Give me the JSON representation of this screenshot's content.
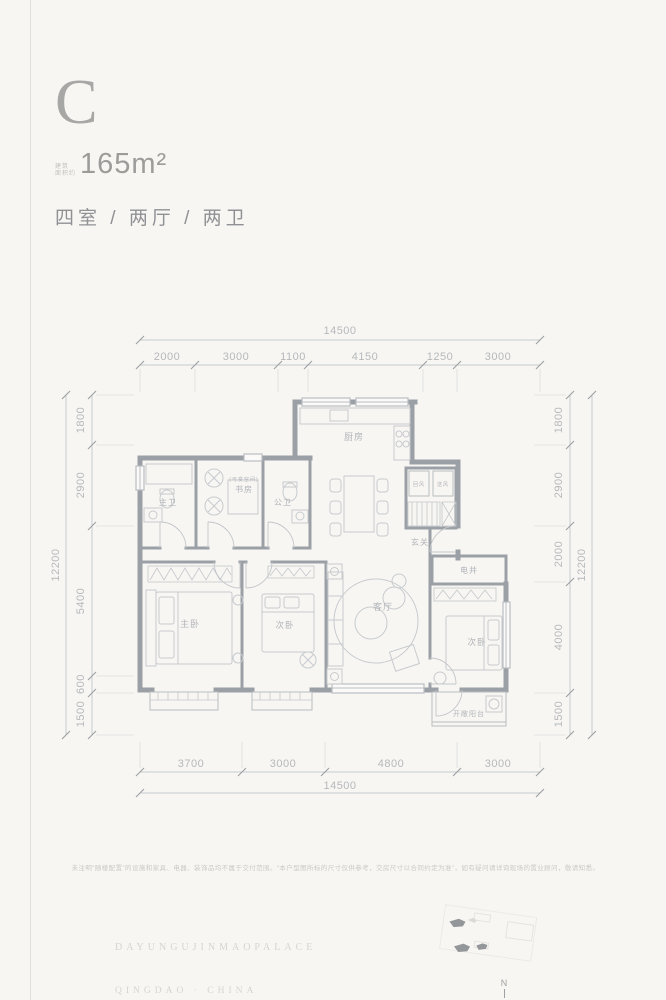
{
  "header": {
    "unit_letter": "C",
    "area_label_line1": "建筑",
    "area_label_line2": "面积约",
    "area_value": "165m²",
    "layout_text": "四室 / 两厅 / 两卫"
  },
  "plan": {
    "rooms": {
      "kitchen": "厨房",
      "master_bath": "主卫",
      "study": "书房",
      "study_note": "(可变空间)",
      "guest_bath": "公卫",
      "foyer": "玄关",
      "shaft_left": "回风",
      "shaft_right": "送风",
      "utility_shaft": "电井",
      "master_bedroom": "主卧",
      "bedroom_2": "次卧",
      "living_room": "客厅",
      "bedroom_3": "次卧",
      "balcony": "开敞阳台"
    },
    "dims": {
      "top_total": "14500",
      "top_segments": [
        "2000",
        "3000",
        "1100",
        "4150",
        "1250",
        "3000"
      ],
      "bottom_total": "14500",
      "bottom_segments": [
        "3700",
        "3000",
        "4800",
        "3000"
      ],
      "left_total": "12200",
      "left_segments": [
        "1800",
        "2900",
        "5400",
        "600",
        "1500"
      ],
      "right_total": "12200",
      "right_segments": [
        "1800",
        "2900",
        "2000",
        "4000",
        "1500"
      ]
    }
  },
  "footer": {
    "disclaimer": "未注明“随楼配置”的设施和家具、电器、装饰品均不属于交付范围。“本户型图所标的尺寸仅供参考，交房尺寸以合同约定为准”，如有疑问请详询现场的置业顾问，敬请知悉。",
    "project_name_en": "DAYUNGUJINMAOPALACE",
    "city_en": "QINGDAO · CHINA",
    "compass_label": "N"
  }
}
